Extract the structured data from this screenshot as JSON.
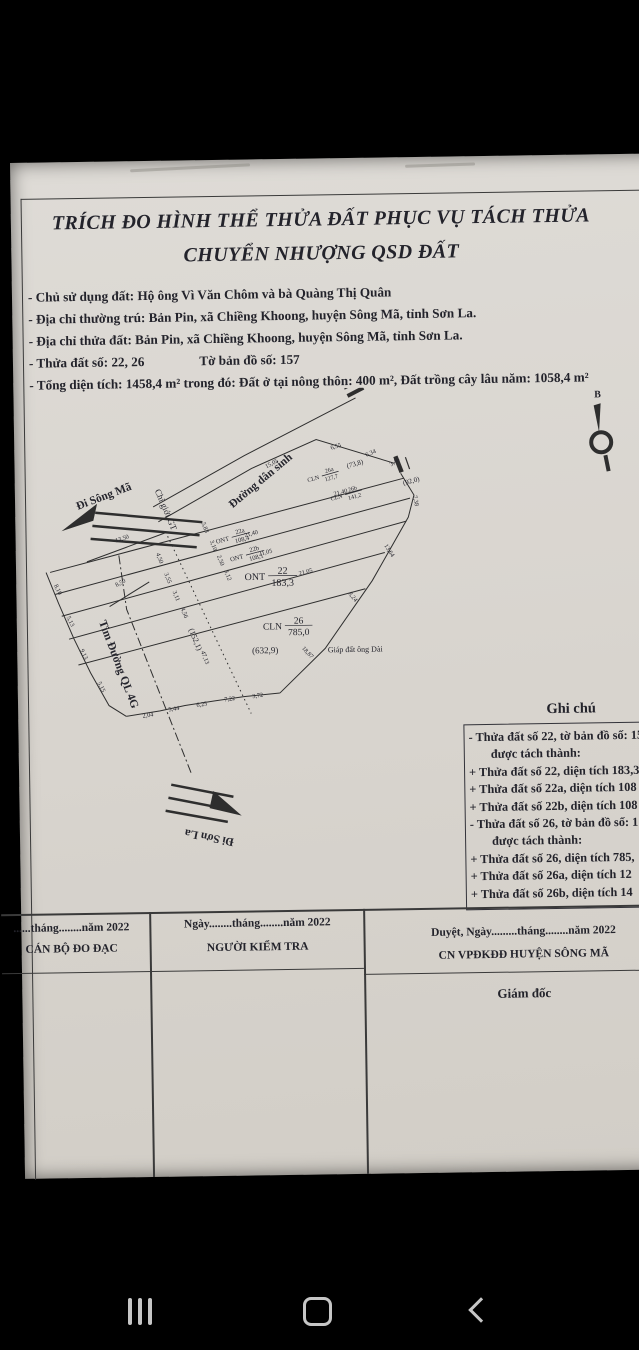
{
  "colors": {
    "paper": "#d9d5cf",
    "ink": "#23232b",
    "line": "#2e2e2e",
    "nav_icon": "#c6c6c6",
    "background": "#000000"
  },
  "document": {
    "title_line1": "TRÍCH ĐO HÌNH THỂ THỬA ĐẤT PHỤC VỤ TÁCH THỬA",
    "title_line2": "CHUYỂN NHƯỢNG QSD ĐẤT",
    "info_lines": [
      {
        "text": "- Chủ sử dụng đất: Hộ ông Vì Văn Chôm và bà Quàng Thị Quân"
      },
      {
        "text": "- Địa chỉ thường trú: Bản Pin, xã Chiềng Khoong, huyện Sông Mã, tỉnh Sơn La."
      },
      {
        "text": "- Địa chỉ thửa đất: Bản Pin, xã Chiềng Khoong, huyện Sông Mã, tỉnh Sơn La."
      },
      {
        "text": "- Thửa đất số: 22, 26",
        "right": "Tờ bản đồ số: 157"
      },
      {
        "text": "- Tổng diện tích: 1458,4 m² trong đó:  Đất ở tại nông thôn: 400 m², Đất trồng cây lâu năm: 1058,4 m²"
      }
    ]
  },
  "map": {
    "labels": [
      {
        "text": "Đi Sông Mã",
        "x": 100,
        "y": 500,
        "rot": -20,
        "size": 11.5,
        "w": 600
      },
      {
        "text": "Chỉ giới GT",
        "x": 158,
        "y": 512,
        "rot": 68,
        "size": 9,
        "w": 400
      },
      {
        "text": "Đường dân sinh",
        "x": 258,
        "y": 486,
        "rot": -39,
        "size": 11.5,
        "w": 600
      },
      {
        "text": "Tim Đường QL 4G",
        "x": 108,
        "y": 666,
        "rot": 70,
        "size": 11.5,
        "w": 600
      },
      {
        "text": "Đi Sơn La",
        "x": 200,
        "y": 836,
        "rot": 192,
        "size": 11.5,
        "w": 600
      },
      {
        "text": "Giáp đất ông Dài",
        "x": 348,
        "y": 656,
        "rot": 0,
        "size": 8,
        "w": 400
      },
      {
        "text": "(632,9)",
        "x": 258,
        "y": 656,
        "rot": 0,
        "size": 9,
        "w": 400
      },
      {
        "text": "(152,1)",
        "x": 186,
        "y": 642,
        "rot": 68,
        "size": 8,
        "w": 400
      },
      {
        "text": "(73,8)",
        "x": 351,
        "y": 470,
        "rot": -15,
        "size": 7,
        "w": 400
      },
      {
        "text": "(92,0)",
        "x": 407,
        "y": 488,
        "rot": -15,
        "size": 7,
        "w": 400
      },
      {
        "text": "B",
        "x": 594,
        "y": 405,
        "rot": 0,
        "size": 10,
        "w": 700
      }
    ],
    "fractions": [
      {
        "pre": "CLN",
        "top": "26a",
        "bottom": "127,7",
        "x": 317,
        "y": 479,
        "rot": -15,
        "size": 6
      },
      {
        "pre": "CLN",
        "top": "26b",
        "bottom": "141,2",
        "x": 340,
        "y": 498,
        "rot": -15,
        "size": 6
      },
      {
        "pre": "ONT",
        "top": "22a",
        "bottom": "108,4",
        "x": 226,
        "y": 539,
        "rot": -14,
        "size": 6.5
      },
      {
        "pre": "ONT",
        "top": "22b",
        "bottom": "108,1",
        "x": 240,
        "y": 557,
        "rot": -14,
        "size": 6.5
      },
      {
        "pre": "ONT",
        "top": "22",
        "bottom": "183,3",
        "x": 262,
        "y": 578,
        "rot": 0,
        "size": 10
      },
      {
        "pre": "CLN",
        "top": "26",
        "bottom": "785,0",
        "x": 278,
        "y": 628,
        "rot": 0,
        "size": 9.5
      }
    ],
    "dims": [
      {
        "text": "13,50",
        "x": 117,
        "y": 541,
        "rot": -17
      },
      {
        "text": "8,50",
        "x": 115,
        "y": 585,
        "rot": -28
      },
      {
        "text": "15,05",
        "x": 268,
        "y": 468,
        "rot": -27
      },
      {
        "text": "6,55",
        "x": 332,
        "y": 452,
        "rot": -15
      },
      {
        "text": "6,34",
        "x": 367,
        "y": 459,
        "rot": -22
      },
      {
        "text": "3,46",
        "x": 391,
        "y": 468,
        "rot": -35
      },
      {
        "text": "21,40",
        "x": 336,
        "y": 498,
        "rot": -14
      },
      {
        "text": "21,40",
        "x": 246,
        "y": 538,
        "rot": -14
      },
      {
        "text": "21,05",
        "x": 260,
        "y": 557,
        "rot": -14
      },
      {
        "text": "21,05",
        "x": 300,
        "y": 577,
        "rot": -14
      },
      {
        "text": "7,38",
        "x": 409,
        "y": 506,
        "rot": 80
      },
      {
        "text": "13,64",
        "x": 382,
        "y": 556,
        "rot": 58
      },
      {
        "text": "8,24",
        "x": 345,
        "y": 602,
        "rot": 52
      },
      {
        "text": "18,87",
        "x": 299,
        "y": 657,
        "rot": 48
      },
      {
        "text": "47,13",
        "x": 196,
        "y": 660,
        "rot": 70
      },
      {
        "text": "5,83",
        "x": 198,
        "y": 530,
        "rot": 70
      },
      {
        "text": "3,10",
        "x": 206,
        "y": 548,
        "rot": 70
      },
      {
        "text": "2,50",
        "x": 213,
        "y": 563,
        "rot": 70
      },
      {
        "text": "3,12",
        "x": 220,
        "y": 578,
        "rot": 70
      },
      {
        "text": "4,50",
        "x": 152,
        "y": 560,
        "rot": 70
      },
      {
        "text": "3,55",
        "x": 160,
        "y": 580,
        "rot": 70
      },
      {
        "text": "3,11",
        "x": 168,
        "y": 598,
        "rot": 70
      },
      {
        "text": "4,56",
        "x": 176,
        "y": 615,
        "rot": 70
      },
      {
        "text": "8,10",
        "x": 50,
        "y": 590,
        "rot": 65
      },
      {
        "text": "5,13",
        "x": 62,
        "y": 622,
        "rot": 65
      },
      {
        "text": "9,13",
        "x": 75,
        "y": 655,
        "rot": 65
      },
      {
        "text": "5,15",
        "x": 92,
        "y": 688,
        "rot": 65
      },
      {
        "text": "2,04",
        "x": 140,
        "y": 718,
        "rot": -8
      },
      {
        "text": "5,44",
        "x": 166,
        "y": 712,
        "rot": -8
      },
      {
        "text": "6,25",
        "x": 194,
        "y": 708,
        "rot": -8
      },
      {
        "text": "7,22",
        "x": 222,
        "y": 703,
        "rot": -8
      },
      {
        "text": "3,72",
        "x": 250,
        "y": 700,
        "rot": -8
      }
    ]
  },
  "notes": {
    "heading": "Ghi chú",
    "lines": [
      "- Thửa đất số 22, tờ bản đồ số: 15",
      "được tách thành:",
      "+ Thửa đất số 22, diện tích 183,3",
      "+ Thửa đất số 22a, diện tích 108",
      "+ Thửa đất số 22b, diện tích 108",
      "- Thửa đất số 26, tờ bản đồ số: 1",
      "được tách thành:",
      "+ Thửa đất số 26, diện tích 785,",
      "+ Thửa đất số 26a, diện tích 12",
      "+ Thửa đất số 26b, diện tích 14"
    ]
  },
  "signature_table": {
    "col1": {
      "date_line": "......tháng........năm 2022",
      "role": "CÁN BỘ ĐO ĐẠC"
    },
    "col2": {
      "date_line": "Ngày........tháng........năm 2022",
      "role": "NGƯỜI KIỂM TRA"
    },
    "col3": {
      "date_line": "Duyệt, Ngày.........tháng........năm 2022",
      "role": "CN VPĐKĐĐ HUYỆN SÔNG MÃ",
      "signer": "Giám đốc"
    }
  }
}
